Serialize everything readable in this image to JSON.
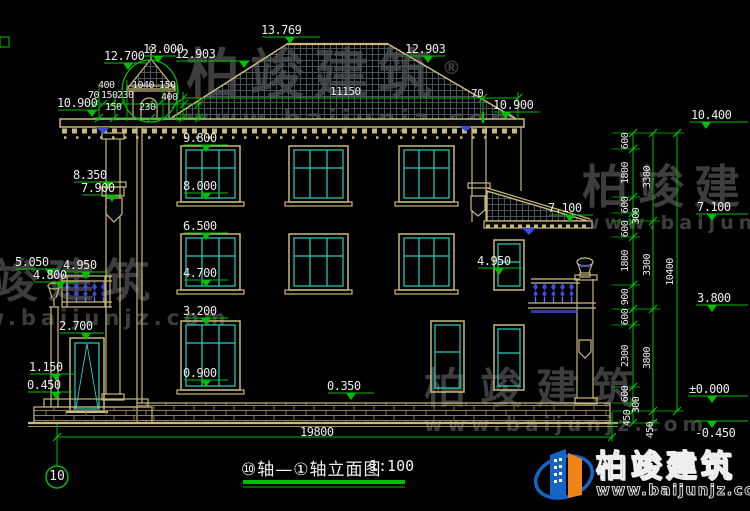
{
  "colors": {
    "background": "#000000",
    "dimension_green": "#00c000",
    "building_tan": "#c9b97c",
    "window_cyan": "#2ad0c0",
    "ornament_blue": "#4a5cff",
    "label_white": "#ebebeb",
    "watermark_gray": "#9a9a9a",
    "logo_blue": "#1565c8",
    "logo_orange": "#f08418"
  },
  "drawing": {
    "title": "⑩轴—①轴立面图",
    "scale": "1:100",
    "axis_bubble": "10",
    "total_width_dim": "19800",
    "total_height_dim": "10400"
  },
  "watermark": {
    "brand": "柏竣建筑",
    "registered": "®",
    "url": "www.baijunjz.com"
  },
  "logo": {
    "brand": "柏竣建筑",
    "url": "www.baijunjz.com"
  },
  "right_chain": {
    "col1": [
      "600",
      "1800",
      "600",
      "300",
      "600",
      "1800",
      "900",
      "600",
      "2300",
      "600",
      "300",
      "450"
    ],
    "col2": [
      "3300",
      "3300",
      "3800",
      "450"
    ],
    "col3": [
      "10400"
    ],
    "elevations": [
      "10.400",
      "7.100",
      "3.800",
      "±0.000",
      "-0.450"
    ]
  },
  "annotations": [
    {
      "n": "dim-12700",
      "t": "12.700",
      "x": 104,
      "y": 50,
      "fs": 12
    },
    {
      "n": "dim-13000",
      "t": "13.000",
      "x": 143,
      "y": 43,
      "fs": 12
    },
    {
      "n": "dim-12903-left",
      "t": "12.903",
      "x": 175,
      "y": 48,
      "fs": 12
    },
    {
      "n": "dim-13769",
      "t": "13.769",
      "x": 261,
      "y": 24,
      "fs": 12
    },
    {
      "n": "dim-12903-right",
      "t": "12.903",
      "x": 405,
      "y": 43,
      "fs": 12
    },
    {
      "n": "dim-11150",
      "t": "11150",
      "x": 330,
      "y": 86,
      "fs": 11
    },
    {
      "n": "dim-70-right",
      "t": "70",
      "x": 471,
      "y": 88,
      "fs": 11
    },
    {
      "n": "lvl-10900-right",
      "t": "10.900",
      "x": 493,
      "y": 99,
      "fs": 12
    },
    {
      "n": "lvl-10900-left",
      "t": "10.900",
      "x": 57,
      "y": 97,
      "fs": 12
    },
    {
      "n": "dim-400-a",
      "t": "400",
      "x": 98,
      "y": 81,
      "fs": 10
    },
    {
      "n": "dim-1040",
      "t": "1040",
      "x": 132,
      "y": 81,
      "fs": 10
    },
    {
      "n": "dim-150-a",
      "t": "150",
      "x": 159,
      "y": 81,
      "fs": 10
    },
    {
      "n": "dim-70-left",
      "t": "70",
      "x": 88,
      "y": 91,
      "fs": 10
    },
    {
      "n": "dim-150-b",
      "t": "150",
      "x": 101,
      "y": 91,
      "fs": 10
    },
    {
      "n": "dim-230-a",
      "t": "230",
      "x": 117,
      "y": 91,
      "fs": 10
    },
    {
      "n": "dim-400-b",
      "t": "400",
      "x": 161,
      "y": 93,
      "fs": 10
    },
    {
      "n": "dim-150-c",
      "t": "150",
      "x": 105,
      "y": 103,
      "fs": 10
    },
    {
      "n": "dim-230-b",
      "t": "230",
      "x": 139,
      "y": 103,
      "fs": 10
    },
    {
      "n": "lvl-8350",
      "t": "8.350",
      "x": 73,
      "y": 169,
      "fs": 12
    },
    {
      "n": "lvl-7900",
      "t": "7.900",
      "x": 81,
      "y": 182,
      "fs": 12
    },
    {
      "n": "lvl-5050",
      "t": "5.050",
      "x": 15,
      "y": 256,
      "fs": 12
    },
    {
      "n": "lvl-4950-left",
      "t": "4.950",
      "x": 63,
      "y": 259,
      "fs": 12
    },
    {
      "n": "lvl-4800",
      "t": "4.800",
      "x": 33,
      "y": 269,
      "fs": 12
    },
    {
      "n": "lvl-2700",
      "t": "2.700",
      "x": 59,
      "y": 320,
      "fs": 12
    },
    {
      "n": "lvl-1150",
      "t": "1.150",
      "x": 29,
      "y": 361,
      "fs": 12
    },
    {
      "n": "lvl-0450",
      "t": "0.450",
      "x": 27,
      "y": 379,
      "fs": 12
    },
    {
      "n": "lvl-9800",
      "t": "9.800",
      "x": 183,
      "y": 132,
      "fs": 12
    },
    {
      "n": "lvl-8000",
      "t": "8.000",
      "x": 183,
      "y": 180,
      "fs": 12
    },
    {
      "n": "lvl-6500",
      "t": "6.500",
      "x": 183,
      "y": 220,
      "fs": 12
    },
    {
      "n": "lvl-4700",
      "t": "4.700",
      "x": 183,
      "y": 267,
      "fs": 12
    },
    {
      "n": "lvl-3200",
      "t": "3.200",
      "x": 183,
      "y": 305,
      "fs": 12
    },
    {
      "n": "lvl-0900",
      "t": "0.900",
      "x": 183,
      "y": 367,
      "fs": 12
    },
    {
      "n": "lvl-0350",
      "t": "0.350",
      "x": 327,
      "y": 380,
      "fs": 12
    },
    {
      "n": "lvl-7100-center",
      "t": "7.100",
      "x": 548,
      "y": 202,
      "fs": 12
    },
    {
      "n": "lvl-4950-right",
      "t": "4.950",
      "x": 477,
      "y": 255,
      "fs": 12
    },
    {
      "n": "lvl-10400",
      "t": "10.400",
      "x": 691,
      "y": 109,
      "fs": 12
    },
    {
      "n": "lvl-7100-right",
      "t": "7.100",
      "x": 697,
      "y": 201,
      "fs": 12
    },
    {
      "n": "lvl-3800",
      "t": "3.800",
      "x": 697,
      "y": 292,
      "fs": 12
    },
    {
      "n": "lvl-0000",
      "t": "±0.000",
      "x": 689,
      "y": 383,
      "fs": 12
    },
    {
      "n": "lvl-neg0450",
      "t": "-0.450",
      "x": 695,
      "y": 427,
      "fs": 12
    },
    {
      "n": "dim-19800",
      "t": "19800",
      "x": 300,
      "y": 426,
      "fs": 12
    },
    {
      "n": "ch-600-1",
      "t": "600",
      "x": 626,
      "y": 141,
      "fs": 10,
      "rot": 1
    },
    {
      "n": "ch-1800-1",
      "t": "1800",
      "x": 626,
      "y": 173,
      "fs": 10,
      "rot": 1
    },
    {
      "n": "ch-600-2",
      "t": "600",
      "x": 626,
      "y": 205,
      "fs": 10,
      "rot": 1
    },
    {
      "n": "ch-300-1",
      "t": "300",
      "x": 637,
      "y": 216,
      "fs": 10,
      "rot": 1
    },
    {
      "n": "ch-600-3",
      "t": "600",
      "x": 626,
      "y": 229,
      "fs": 10,
      "rot": 1
    },
    {
      "n": "ch-1800-2",
      "t": "1800",
      "x": 626,
      "y": 261,
      "fs": 10,
      "rot": 1
    },
    {
      "n": "ch-900",
      "t": "900",
      "x": 626,
      "y": 297,
      "fs": 10,
      "rot": 1
    },
    {
      "n": "ch-600-4",
      "t": "600",
      "x": 626,
      "y": 317,
      "fs": 10,
      "rot": 1
    },
    {
      "n": "ch-2300",
      "t": "2300",
      "x": 626,
      "y": 356,
      "fs": 10,
      "rot": 1
    },
    {
      "n": "ch-600-5",
      "t": "600",
      "x": 626,
      "y": 394,
      "fs": 10,
      "rot": 1
    },
    {
      "n": "ch-300-2",
      "t": "300",
      "x": 637,
      "y": 405,
      "fs": 10,
      "rot": 1
    },
    {
      "n": "ch-450-1",
      "t": "450",
      "x": 628,
      "y": 418,
      "fs": 10,
      "rot": 1
    },
    {
      "n": "ch-3300-1",
      "t": "3300",
      "x": 648,
      "y": 177,
      "fs": 10,
      "rot": 1
    },
    {
      "n": "ch-3300-2",
      "t": "3300",
      "x": 648,
      "y": 265,
      "fs": 10,
      "rot": 1
    },
    {
      "n": "ch-3800",
      "t": "3800",
      "x": 648,
      "y": 358,
      "fs": 10,
      "rot": 1
    },
    {
      "n": "ch-450-2",
      "t": "450",
      "x": 651,
      "y": 430,
      "fs": 10,
      "rot": 1
    },
    {
      "n": "ch-10400",
      "t": "10400",
      "x": 671,
      "y": 272,
      "fs": 10,
      "rot": 1
    }
  ]
}
